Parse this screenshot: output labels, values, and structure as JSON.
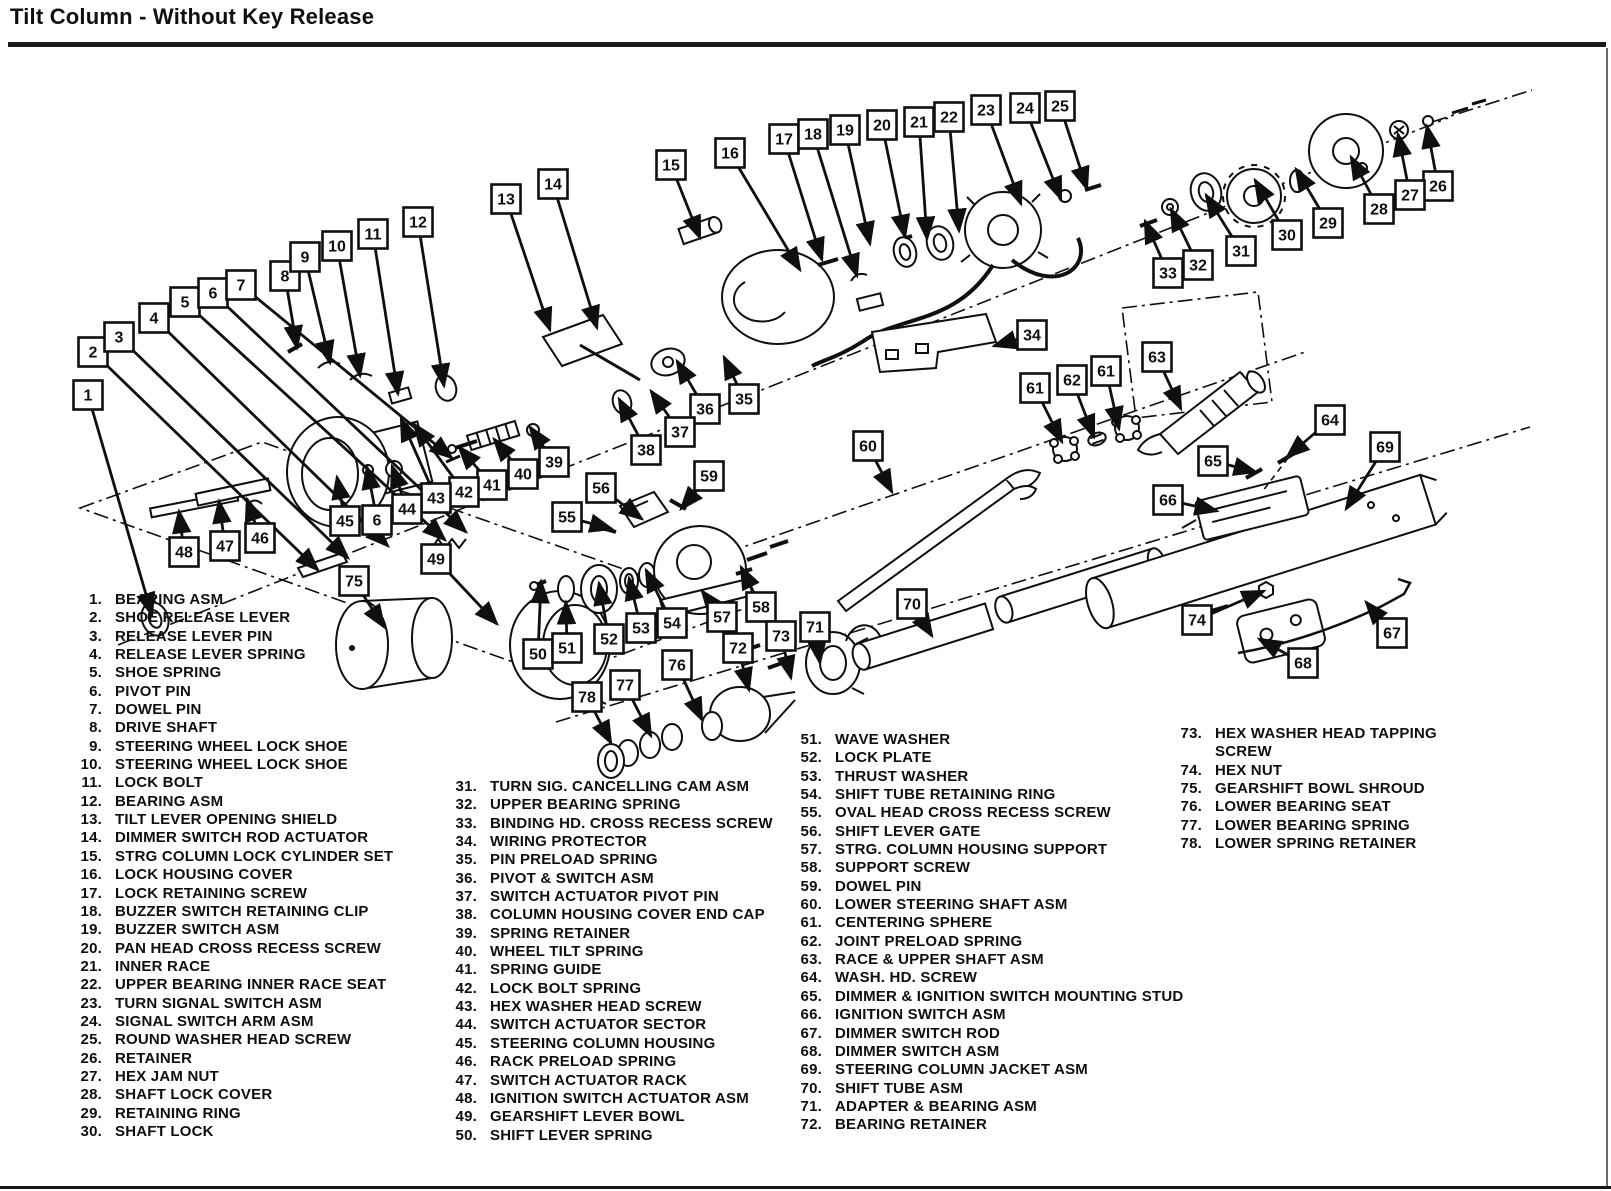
{
  "title": "Tilt Column - Without Key Release",
  "diagram": {
    "callouts": [
      {
        "n": "1",
        "x": 88,
        "y": 395,
        "tx": 152,
        "ty": 615
      },
      {
        "n": "2",
        "x": 93,
        "y": 352,
        "tx": 318,
        "ty": 570
      },
      {
        "n": "3",
        "x": 119,
        "y": 337,
        "tx": 348,
        "ty": 558
      },
      {
        "n": "4",
        "x": 154,
        "y": 318,
        "tx": 388,
        "ty": 546
      },
      {
        "n": "5",
        "x": 185,
        "y": 302,
        "tx": 445,
        "ty": 540
      },
      {
        "n": "6",
        "x": 213,
        "y": 293,
        "tx": 466,
        "ty": 532
      },
      {
        "n": "7",
        "x": 241,
        "y": 285,
        "tx": 452,
        "ty": 458
      },
      {
        "n": "8",
        "x": 285,
        "y": 276,
        "tx": 297,
        "ty": 348
      },
      {
        "n": "9",
        "x": 305,
        "y": 257,
        "tx": 330,
        "ty": 363
      },
      {
        "n": "10",
        "x": 337,
        "y": 246,
        "tx": 360,
        "ty": 376
      },
      {
        "n": "11",
        "x": 373,
        "y": 234,
        "tx": 398,
        "ty": 394
      },
      {
        "n": "12",
        "x": 418,
        "y": 222,
        "tx": 444,
        "ty": 386
      },
      {
        "n": "13",
        "x": 506,
        "y": 199,
        "tx": 550,
        "ty": 330
      },
      {
        "n": "14",
        "x": 553,
        "y": 184,
        "tx": 597,
        "ty": 328
      },
      {
        "n": "15",
        "x": 671,
        "y": 165,
        "tx": 700,
        "ty": 238
      },
      {
        "n": "16",
        "x": 730,
        "y": 153,
        "tx": 800,
        "ty": 270
      },
      {
        "n": "17",
        "x": 784,
        "y": 139,
        "tx": 822,
        "ty": 260
      },
      {
        "n": "18",
        "x": 813,
        "y": 134,
        "tx": 857,
        "ty": 276
      },
      {
        "n": "19",
        "x": 845,
        "y": 130,
        "tx": 870,
        "ty": 244
      },
      {
        "n": "20",
        "x": 882,
        "y": 125,
        "tx": 905,
        "ty": 237
      },
      {
        "n": "21",
        "x": 919,
        "y": 122,
        "tx": 927,
        "ty": 239
      },
      {
        "n": "22",
        "x": 949,
        "y": 117,
        "tx": 959,
        "ty": 231
      },
      {
        "n": "23",
        "x": 986,
        "y": 110,
        "tx": 1021,
        "ty": 204
      },
      {
        "n": "24",
        "x": 1025,
        "y": 108,
        "tx": 1061,
        "ty": 199
      },
      {
        "n": "25",
        "x": 1060,
        "y": 106,
        "tx": 1087,
        "ty": 189
      },
      {
        "n": "26",
        "x": 1438,
        "y": 186,
        "tx": 1427,
        "ty": 126
      },
      {
        "n": "27",
        "x": 1410,
        "y": 195,
        "tx": 1398,
        "ty": 134
      },
      {
        "n": "28",
        "x": 1379,
        "y": 209,
        "tx": 1351,
        "ty": 157
      },
      {
        "n": "29",
        "x": 1328,
        "y": 223,
        "tx": 1296,
        "ty": 169
      },
      {
        "n": "30",
        "x": 1287,
        "y": 235,
        "tx": 1255,
        "ty": 180
      },
      {
        "n": "31",
        "x": 1241,
        "y": 251,
        "tx": 1206,
        "ty": 195
      },
      {
        "n": "32",
        "x": 1198,
        "y": 265,
        "tx": 1171,
        "ty": 209
      },
      {
        "n": "33",
        "x": 1168,
        "y": 273,
        "tx": 1145,
        "ty": 221
      },
      {
        "n": "34",
        "x": 1032,
        "y": 335,
        "tx": 994,
        "ty": 346
      },
      {
        "n": "35",
        "x": 744,
        "y": 399,
        "tx": 724,
        "ty": 357
      },
      {
        "n": "36",
        "x": 705,
        "y": 409,
        "tx": 677,
        "ty": 361
      },
      {
        "n": "37",
        "x": 680,
        "y": 432,
        "tx": 651,
        "ty": 391
      },
      {
        "n": "38",
        "x": 646,
        "y": 450,
        "tx": 619,
        "ty": 399
      },
      {
        "n": "39",
        "x": 554,
        "y": 462,
        "tx": 530,
        "ty": 427
      },
      {
        "n": "40",
        "x": 523,
        "y": 474,
        "tx": 494,
        "ty": 439
      },
      {
        "n": "41",
        "x": 492,
        "y": 485,
        "tx": 459,
        "ty": 447
      },
      {
        "n": "42",
        "x": 464,
        "y": 492,
        "tx": 414,
        "ty": 424
      },
      {
        "n": "43",
        "x": 436,
        "y": 498,
        "tx": 401,
        "ty": 419
      },
      {
        "n": "44",
        "x": 407,
        "y": 509,
        "tx": 392,
        "ty": 466
      },
      {
        "n": "6",
        "x": 377,
        "y": 520,
        "tx": 367,
        "ty": 467
      },
      {
        "n": "45",
        "x": 345,
        "y": 521,
        "tx": 337,
        "ty": 477
      },
      {
        "n": "46",
        "x": 260,
        "y": 538,
        "tx": 247,
        "ty": 499
      },
      {
        "n": "47",
        "x": 225,
        "y": 546,
        "tx": 219,
        "ty": 501
      },
      {
        "n": "48",
        "x": 184,
        "y": 552,
        "tx": 179,
        "ty": 511
      },
      {
        "n": "49",
        "x": 436,
        "y": 559,
        "tx": 497,
        "ty": 624
      },
      {
        "n": "50",
        "x": 538,
        "y": 654,
        "tx": 541,
        "ty": 581
      },
      {
        "n": "51",
        "x": 567,
        "y": 648,
        "tx": 566,
        "ty": 602
      },
      {
        "n": "52",
        "x": 609,
        "y": 639,
        "tx": 599,
        "ty": 583
      },
      {
        "n": "53",
        "x": 641,
        "y": 628,
        "tx": 629,
        "ty": 578
      },
      {
        "n": "54",
        "x": 672,
        "y": 623,
        "tx": 646,
        "ty": 570
      },
      {
        "n": "55",
        "x": 567,
        "y": 517,
        "tx": 612,
        "ty": 529
      },
      {
        "n": "56",
        "x": 601,
        "y": 488,
        "tx": 642,
        "ty": 519
      },
      {
        "n": "57",
        "x": 722,
        "y": 617,
        "tx": 702,
        "ty": 591
      },
      {
        "n": "58",
        "x": 761,
        "y": 607,
        "tx": 741,
        "ty": 567
      },
      {
        "n": "59",
        "x": 709,
        "y": 476,
        "tx": 681,
        "ty": 509
      },
      {
        "n": "60",
        "x": 868,
        "y": 446,
        "tx": 892,
        "ty": 492
      },
      {
        "n": "61",
        "x": 1035,
        "y": 388,
        "tx": 1062,
        "ty": 442
      },
      {
        "n": "62",
        "x": 1072,
        "y": 380,
        "tx": 1094,
        "ty": 437
      },
      {
        "n": "61",
        "x": 1106,
        "y": 371,
        "tx": 1119,
        "ty": 429
      },
      {
        "n": "63",
        "x": 1157,
        "y": 357,
        "tx": 1181,
        "ty": 409
      },
      {
        "n": "64",
        "x": 1330,
        "y": 420,
        "tx": 1287,
        "ty": 457
      },
      {
        "n": "65",
        "x": 1213,
        "y": 461,
        "tx": 1256,
        "ty": 472
      },
      {
        "n": "66",
        "x": 1168,
        "y": 500,
        "tx": 1217,
        "ty": 511
      },
      {
        "n": "67",
        "x": 1392,
        "y": 633,
        "tx": 1366,
        "ty": 602
      },
      {
        "n": "68",
        "x": 1303,
        "y": 663,
        "tx": 1259,
        "ty": 639
      },
      {
        "n": "69",
        "x": 1385,
        "y": 447,
        "tx": 1346,
        "ty": 509
      },
      {
        "n": "70",
        "x": 912,
        "y": 604,
        "tx": 932,
        "ty": 636
      },
      {
        "n": "71",
        "x": 815,
        "y": 627,
        "tx": 820,
        "ty": 663
      },
      {
        "n": "72",
        "x": 738,
        "y": 648,
        "tx": 749,
        "ty": 690
      },
      {
        "n": "73",
        "x": 781,
        "y": 636,
        "tx": 791,
        "ty": 678
      },
      {
        "n": "74",
        "x": 1197,
        "y": 620,
        "tx": 1264,
        "ty": 591
      },
      {
        "n": "75",
        "x": 354,
        "y": 581,
        "tx": 384,
        "ty": 627
      },
      {
        "n": "76",
        "x": 677,
        "y": 665,
        "tx": 702,
        "ty": 720
      },
      {
        "n": "77",
        "x": 625,
        "y": 685,
        "tx": 651,
        "ty": 736
      },
      {
        "n": "78",
        "x": 587,
        "y": 697,
        "tx": 611,
        "ty": 743
      }
    ]
  },
  "parts_list": {
    "columns": [
      {
        "items": [
          {
            "n": "1.",
            "label": "BEARING ASM"
          },
          {
            "n": "2.",
            "label": "SHOE RELEASE LEVER"
          },
          {
            "n": "3.",
            "label": "RELEASE LEVER PIN"
          },
          {
            "n": "4.",
            "label": "RELEASE LEVER SPRING"
          },
          {
            "n": "5.",
            "label": "SHOE SPRING"
          },
          {
            "n": "6.",
            "label": "PIVOT PIN"
          },
          {
            "n": "7.",
            "label": "DOWEL PIN"
          },
          {
            "n": "8.",
            "label": "DRIVE SHAFT"
          },
          {
            "n": "9.",
            "label": "STEERING WHEEL LOCK SHOE"
          },
          {
            "n": "10.",
            "label": "STEERING WHEEL LOCK SHOE"
          },
          {
            "n": "11.",
            "label": "LOCK BOLT"
          },
          {
            "n": "12.",
            "label": "BEARING ASM"
          },
          {
            "n": "13.",
            "label": "TILT LEVER OPENING SHIELD"
          },
          {
            "n": "14.",
            "label": "DIMMER SWITCH ROD ACTUATOR"
          },
          {
            "n": "15.",
            "label": "STRG COLUMN LOCK CYLINDER SET"
          },
          {
            "n": "16.",
            "label": "LOCK HOUSING COVER"
          },
          {
            "n": "17.",
            "label": "LOCK RETAINING SCREW"
          },
          {
            "n": "18.",
            "label": "BUZZER SWITCH RETAINING CLIP"
          },
          {
            "n": "19.",
            "label": "BUZZER SWITCH ASM"
          },
          {
            "n": "20.",
            "label": "PAN HEAD CROSS RECESS SCREW"
          },
          {
            "n": "21.",
            "label": "INNER RACE"
          },
          {
            "n": "22.",
            "label": "UPPER BEARING INNER RACE SEAT"
          },
          {
            "n": "23.",
            "label": "TURN SIGNAL SWITCH ASM"
          },
          {
            "n": "24.",
            "label": "SIGNAL SWITCH ARM ASM"
          },
          {
            "n": "25.",
            "label": "ROUND WASHER HEAD SCREW"
          },
          {
            "n": "26.",
            "label": "RETAINER"
          },
          {
            "n": "27.",
            "label": "HEX JAM NUT"
          },
          {
            "n": "28.",
            "label": "SHAFT LOCK COVER"
          },
          {
            "n": "29.",
            "label": "RETAINING RING"
          },
          {
            "n": "30.",
            "label": "SHAFT LOCK"
          }
        ]
      },
      {
        "items": [
          {
            "n": "31.",
            "label": "TURN SIG. CANCELLING CAM ASM"
          },
          {
            "n": "32.",
            "label": "UPPER BEARING SPRING"
          },
          {
            "n": "33.",
            "label": "BINDING HD. CROSS RECESS SCREW"
          },
          {
            "n": "34.",
            "label": "WIRING PROTECTOR"
          },
          {
            "n": "35.",
            "label": "PIN PRELOAD SPRING"
          },
          {
            "n": "36.",
            "label": "PIVOT & SWITCH ASM"
          },
          {
            "n": "37.",
            "label": "SWITCH ACTUATOR PIVOT PIN"
          },
          {
            "n": "38.",
            "label": "COLUMN HOUSING COVER END CAP"
          },
          {
            "n": "39.",
            "label": "SPRING RETAINER"
          },
          {
            "n": "40.",
            "label": "WHEEL TILT SPRING"
          },
          {
            "n": "41.",
            "label": "SPRING GUIDE"
          },
          {
            "n": "42.",
            "label": "LOCK BOLT SPRING"
          },
          {
            "n": "43.",
            "label": "HEX WASHER HEAD SCREW"
          },
          {
            "n": "44.",
            "label": "SWITCH ACTUATOR SECTOR"
          },
          {
            "n": "45.",
            "label": "STEERING COLUMN HOUSING"
          },
          {
            "n": "46.",
            "label": "RACK PRELOAD SPRING"
          },
          {
            "n": "47.",
            "label": "SWITCH ACTUATOR RACK"
          },
          {
            "n": "48.",
            "label": "IGNITION SWITCH ACTUATOR ASM"
          },
          {
            "n": "49.",
            "label": "GEARSHIFT LEVER BOWL"
          },
          {
            "n": "50.",
            "label": "SHIFT LEVER SPRING"
          }
        ]
      },
      {
        "items": [
          {
            "n": "51.",
            "label": "WAVE WASHER"
          },
          {
            "n": "52.",
            "label": "LOCK PLATE"
          },
          {
            "n": "53.",
            "label": "THRUST WASHER"
          },
          {
            "n": "54.",
            "label": "SHIFT TUBE RETAINING RING"
          },
          {
            "n": "55.",
            "label": "OVAL HEAD CROSS RECESS SCREW"
          },
          {
            "n": "56.",
            "label": "SHIFT LEVER GATE"
          },
          {
            "n": "57.",
            "label": "STRG. COLUMN HOUSING SUPPORT"
          },
          {
            "n": "58.",
            "label": "SUPPORT SCREW"
          },
          {
            "n": "59.",
            "label": "DOWEL PIN"
          },
          {
            "n": "60.",
            "label": "LOWER STEERING SHAFT ASM"
          },
          {
            "n": "61.",
            "label": "CENTERING SPHERE"
          },
          {
            "n": "62.",
            "label": "JOINT PRELOAD SPRING"
          },
          {
            "n": "63.",
            "label": "RACE & UPPER SHAFT ASM"
          },
          {
            "n": "64.",
            "label": "WASH. HD. SCREW"
          },
          {
            "n": "65.",
            "label": "DIMMER & IGNITION SWITCH MOUNTING STUD"
          },
          {
            "n": "66.",
            "label": "IGNITION SWITCH ASM"
          },
          {
            "n": "67.",
            "label": "DIMMER SWITCH ROD"
          },
          {
            "n": "68.",
            "label": "DIMMER SWITCH ASM"
          },
          {
            "n": "69.",
            "label": "STEERING COLUMN JACKET ASM"
          },
          {
            "n": "70.",
            "label": "SHIFT TUBE ASM"
          },
          {
            "n": "71.",
            "label": "ADAPTER & BEARING ASM"
          },
          {
            "n": "72.",
            "label": "BEARING RETAINER"
          }
        ]
      },
      {
        "items": [
          {
            "n": "73.",
            "label": "HEX WASHER HEAD TAPPING SCREW"
          },
          {
            "n": "74.",
            "label": "HEX NUT"
          },
          {
            "n": "75.",
            "label": "GEARSHIFT BOWL SHROUD"
          },
          {
            "n": "76.",
            "label": "LOWER BEARING SEAT"
          },
          {
            "n": "77.",
            "label": "LOWER BEARING SPRING"
          },
          {
            "n": "78.",
            "label": "LOWER SPRING RETAINER"
          }
        ]
      }
    ]
  }
}
